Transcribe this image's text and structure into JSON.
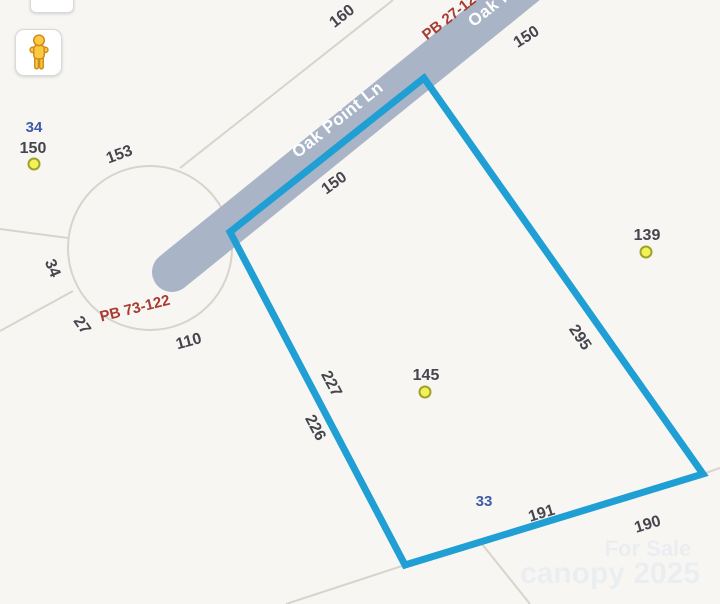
{
  "map": {
    "background": "#f7f6f3",
    "colors": {
      "boundary_blue": "#1f9fd4",
      "road_gray": "#a9b5c6",
      "line_gray": "#d7d4cc",
      "dim_text": "#45454d",
      "lot_text": "#3d5ba9",
      "plat_text": "#a93b32",
      "road_text": "#ffffff",
      "watermark_text": "#e9edf0",
      "dot_fill": "#f3f157",
      "dot_stroke": "#9ea22b"
    },
    "street_name": "Oak Point Ln",
    "subject_parcel": {
      "points": "230,232 424,78 703,474 405,565",
      "stroke_width": 7
    },
    "cul_de_sac": {
      "cx": 150,
      "cy": 248,
      "r": 82
    },
    "road_segment": {
      "x1": 172,
      "y1": 272,
      "x2": 545,
      "y2": -30,
      "width": 40
    },
    "lot_lines": [
      {
        "x1": 393,
        "y1": 0,
        "x2": 180,
        "y2": 168
      },
      {
        "x1": 0,
        "y1": 229,
        "x2": 68,
        "y2": 238
      },
      {
        "x1": 73,
        "y1": 291,
        "x2": 0,
        "y2": 331
      },
      {
        "x1": 405,
        "y1": 565,
        "x2": 286,
        "y2": 604
      },
      {
        "x1": 478,
        "y1": 539,
        "x2": 530,
        "y2": 604
      },
      {
        "x1": 703,
        "y1": 474,
        "x2": 720,
        "y2": 468
      }
    ],
    "parcel_dots": [
      {
        "x": 34,
        "y": 164
      },
      {
        "x": 646,
        "y": 252
      },
      {
        "x": 425,
        "y": 392
      }
    ],
    "labels": [
      {
        "text": "160",
        "x": 345,
        "y": 20,
        "rot": -38,
        "kind": "dim"
      },
      {
        "text": "PB 27-12",
        "x": 452,
        "y": 21,
        "rot": -38,
        "kind": "plat"
      },
      {
        "text": "Oak Point Ln",
        "x": 517,
        "y": -7,
        "rot": -38.5,
        "kind": "road"
      },
      {
        "text": "150",
        "x": 529,
        "y": 41,
        "rot": -32,
        "kind": "dim"
      },
      {
        "text": "Oak Point Ln",
        "x": 341,
        "y": 124,
        "rot": -38.5,
        "kind": "road"
      },
      {
        "text": "150",
        "x": 337,
        "y": 187,
        "rot": -36,
        "kind": "dim"
      },
      {
        "text": "34",
        "x": 34,
        "y": 132,
        "rot": 0,
        "kind": "lot"
      },
      {
        "text": "150",
        "x": 33,
        "y": 153,
        "rot": 0,
        "kind": "dim"
      },
      {
        "text": "153",
        "x": 121,
        "y": 159,
        "rot": -20,
        "kind": "dim"
      },
      {
        "text": "34",
        "x": 48,
        "y": 270,
        "rot": 68,
        "kind": "dim"
      },
      {
        "text": "27",
        "x": 78,
        "y": 328,
        "rot": 55,
        "kind": "dim"
      },
      {
        "text": "PB 73-122",
        "x": 136,
        "y": 313,
        "rot": -14,
        "kind": "plat"
      },
      {
        "text": "110",
        "x": 190,
        "y": 346,
        "rot": -15,
        "kind": "dim"
      },
      {
        "text": "139",
        "x": 647,
        "y": 240,
        "rot": 0,
        "kind": "dim"
      },
      {
        "text": "295",
        "x": 576,
        "y": 340,
        "rot": 56,
        "kind": "dim"
      },
      {
        "text": "227",
        "x": 327,
        "y": 386,
        "rot": 62,
        "kind": "dim"
      },
      {
        "text": "226",
        "x": 311,
        "y": 430,
        "rot": 62,
        "kind": "dim"
      },
      {
        "text": "145",
        "x": 426,
        "y": 380,
        "rot": 0,
        "kind": "dim"
      },
      {
        "text": "33",
        "x": 484,
        "y": 506,
        "rot": 0,
        "kind": "lot"
      },
      {
        "text": "191",
        "x": 543,
        "y": 518,
        "rot": -17,
        "kind": "dim"
      },
      {
        "text": "190",
        "x": 649,
        "y": 529,
        "rot": -17,
        "kind": "dim"
      },
      {
        "text": "For Sale",
        "x": 648,
        "y": 556,
        "rot": 0,
        "kind": "wm1"
      },
      {
        "text": "canopy 2025",
        "x": 610,
        "y": 583,
        "rot": 0,
        "kind": "wm2"
      }
    ]
  },
  "controls": {
    "pegman_icon": "street-view-pegman-icon",
    "partial_control": "map-control-partial"
  }
}
